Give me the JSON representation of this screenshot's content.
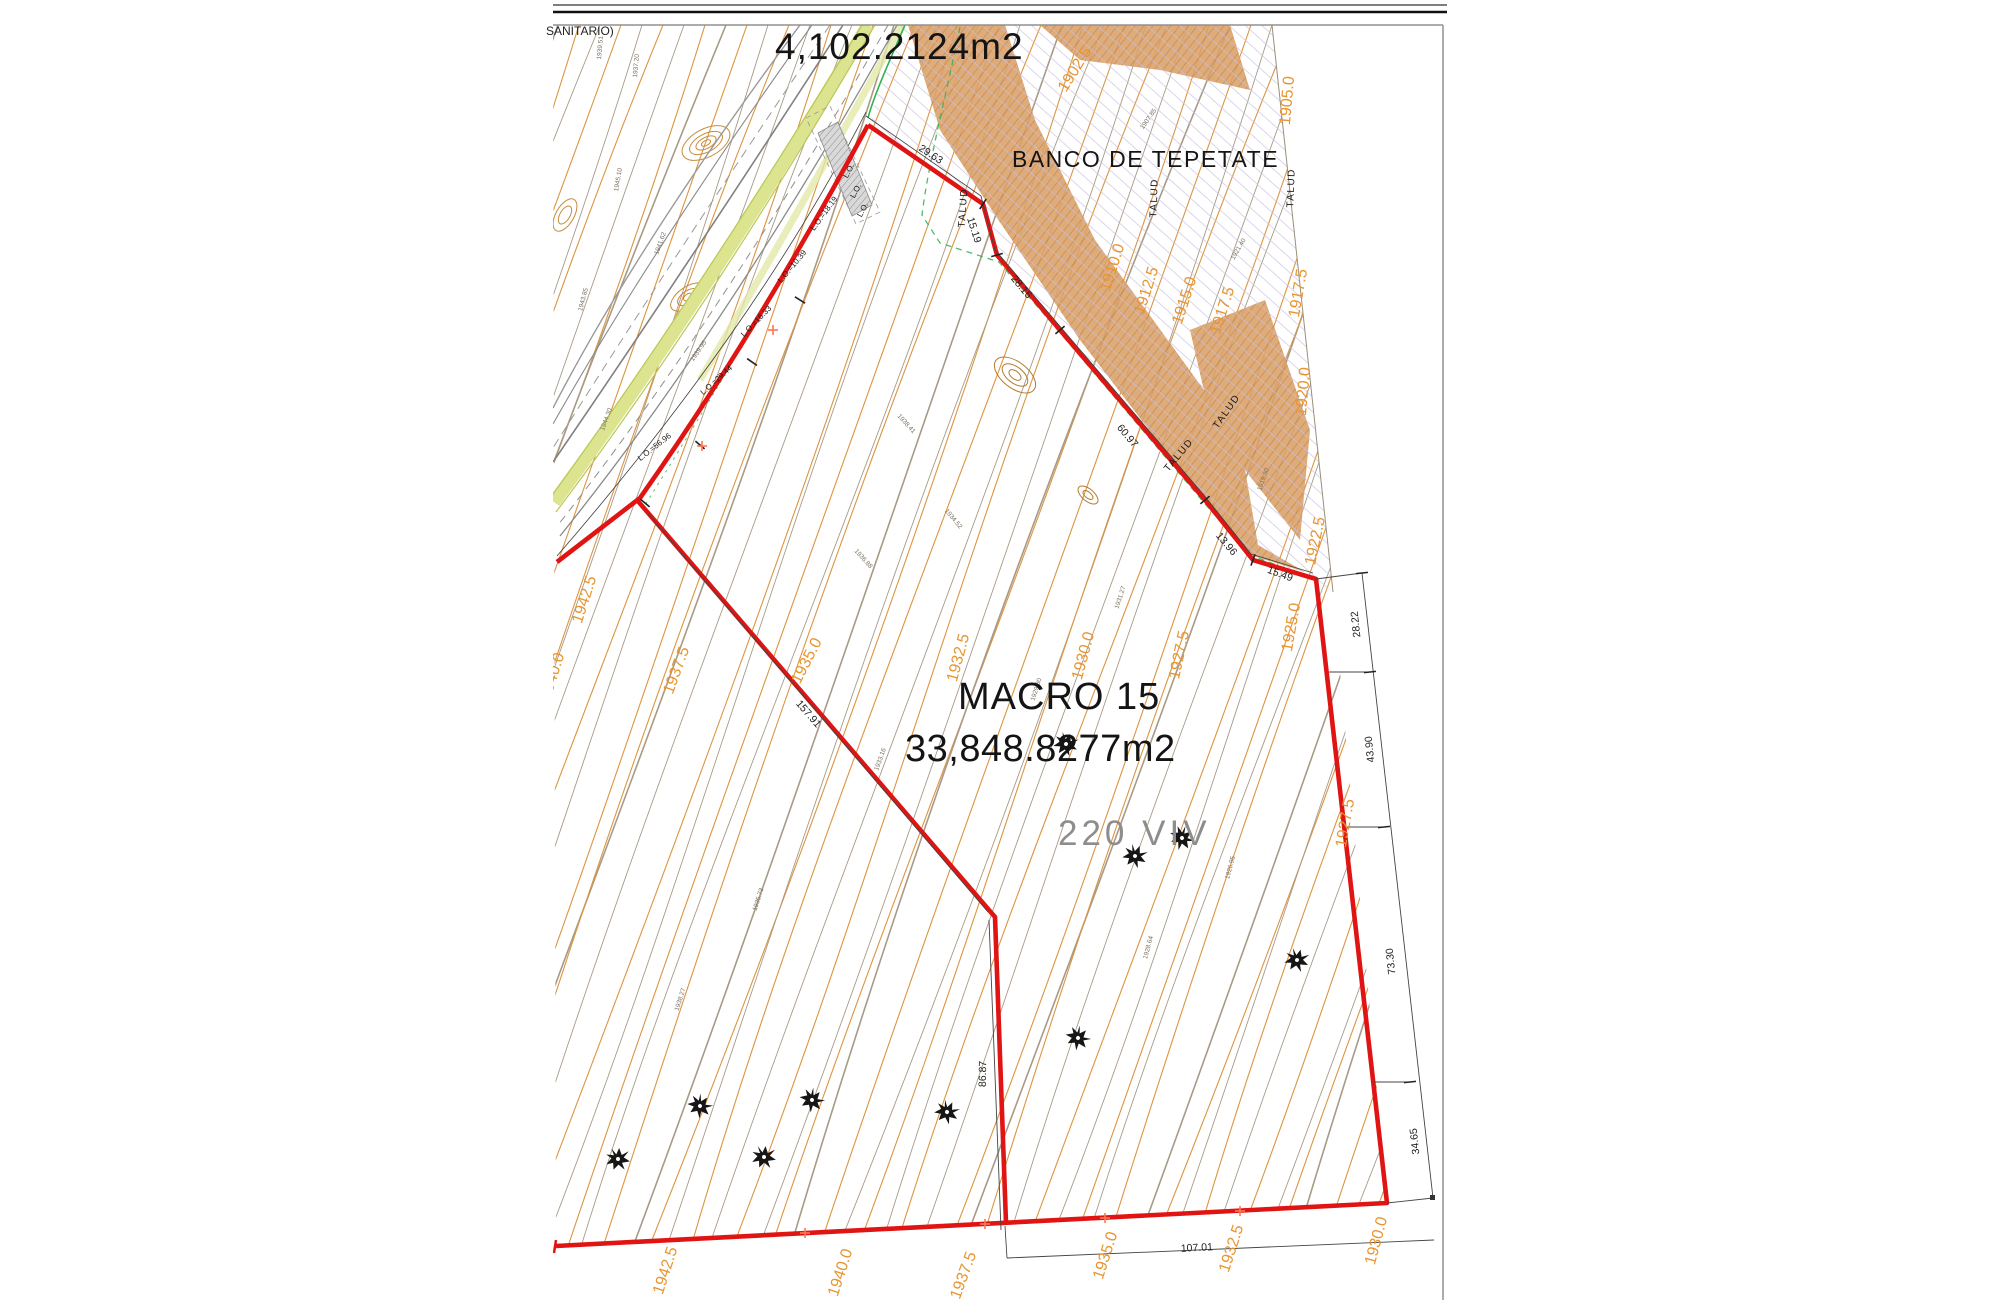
{
  "labels": {
    "area_top": "4,102.2124m2",
    "banco": "BANCO DE TEPETATE",
    "macro_title": "MACRO 15",
    "macro_area": "33,848.8277m2",
    "viviendas": "220 VIV",
    "sanitario": "SANITARIO)"
  },
  "colors": {
    "boundary_red": "#e11414",
    "contour_orange": "#dd9440",
    "contour_gray": "#a89a86",
    "label_orange": "#e8952f",
    "hatch_purple": "#c7c0e0",
    "talud_fill": "#daa068",
    "talud_stripe": "#bf7a38",
    "green_band": "#dce48f",
    "green_line": "#2fb14b",
    "dim_gray": "#444444"
  },
  "dimension_labels": [
    {
      "t": "29.63",
      "x": 929,
      "y": 157,
      "r": 33
    },
    {
      "t": "15.19",
      "x": 971,
      "y": 231,
      "r": 72
    },
    {
      "t": "28.16",
      "x": 1019,
      "y": 289,
      "r": 50
    },
    {
      "t": "60.97",
      "x": 1125,
      "y": 438,
      "r": 50
    },
    {
      "t": "13.96",
      "x": 1224,
      "y": 546,
      "r": 50
    },
    {
      "t": "15.49",
      "x": 1279,
      "y": 577,
      "r": 20
    },
    {
      "t": "28.22",
      "x": 1359,
      "y": 624,
      "r": -96
    },
    {
      "t": "43.90",
      "x": 1373,
      "y": 749,
      "r": -96
    },
    {
      "t": "73.30",
      "x": 1394,
      "y": 961,
      "r": -96
    },
    {
      "t": "34.65",
      "x": 1418,
      "y": 1141,
      "r": -96
    },
    {
      "t": "107.01",
      "x": 1197,
      "y": 1251,
      "r": -3
    },
    {
      "t": "86.87",
      "x": 986,
      "y": 1074,
      "r": -89
    },
    {
      "t": "157.91",
      "x": 806,
      "y": 716,
      "r": 49
    }
  ],
  "lo_labels": [
    {
      "t": "L.O.=56.96",
      "x": 656,
      "y": 449,
      "r": -38
    },
    {
      "t": "L.O.=29.44",
      "x": 718,
      "y": 382,
      "r": -42
    },
    {
      "t": "L.O.=16.33",
      "x": 758,
      "y": 323,
      "r": -46
    },
    {
      "t": "L.O.=10.39",
      "x": 794,
      "y": 268,
      "r": -50
    },
    {
      "t": "L.O.=18.19",
      "x": 826,
      "y": 215,
      "r": -54
    },
    {
      "t": "L.O.",
      "x": 851,
      "y": 172,
      "r": -62
    },
    {
      "t": "L.O.",
      "x": 858,
      "y": 192,
      "r": -62
    },
    {
      "t": "L.O.",
      "x": 865,
      "y": 211,
      "r": -62
    }
  ],
  "contour_labels": [
    {
      "t": "1942.5",
      "x": 670,
      "y": 1272,
      "r": -72
    },
    {
      "t": "1940.0",
      "x": 845,
      "y": 1274,
      "r": -72
    },
    {
      "t": "1937.5",
      "x": 968,
      "y": 1277,
      "r": -70
    },
    {
      "t": "1935.0",
      "x": 1110,
      "y": 1257,
      "r": -72
    },
    {
      "t": "1932.5",
      "x": 1236,
      "y": 1250,
      "r": -72
    },
    {
      "t": "1930.0",
      "x": 1381,
      "y": 1242,
      "r": -75
    },
    {
      "t": "1937.5",
      "x": 681,
      "y": 672,
      "r": -70
    },
    {
      "t": "1935.0",
      "x": 811,
      "y": 663,
      "r": -63
    },
    {
      "t": "1932.5",
      "x": 963,
      "y": 659,
      "r": -75
    },
    {
      "t": "1930.0",
      "x": 1088,
      "y": 657,
      "r": -75
    },
    {
      "t": "1927.5",
      "x": 1184,
      "y": 656,
      "r": -78
    },
    {
      "t": "1925.0",
      "x": 1296,
      "y": 628,
      "r": -80
    },
    {
      "t": "1927.5",
      "x": 1350,
      "y": 824,
      "r": -80
    },
    {
      "t": "1942.5",
      "x": 589,
      "y": 601,
      "r": -72
    },
    {
      "t": "1940.0",
      "x": 557,
      "y": 678,
      "r": -72
    },
    {
      "t": "1905.0",
      "x": 1292,
      "y": 101,
      "r": -85
    },
    {
      "t": "1902.5",
      "x": 1079,
      "y": 72,
      "r": -58
    },
    {
      "t": "1910.0",
      "x": 1117,
      "y": 269,
      "r": -72
    },
    {
      "t": "1912.5",
      "x": 1151,
      "y": 292,
      "r": -72
    },
    {
      "t": "1915.0",
      "x": 1189,
      "y": 302,
      "r": -72
    },
    {
      "t": "1917.5",
      "x": 1227,
      "y": 312,
      "r": -72
    },
    {
      "t": "1917.5",
      "x": 1303,
      "y": 294,
      "r": -80
    },
    {
      "t": "1920.0",
      "x": 1308,
      "y": 392,
      "r": -85
    },
    {
      "t": "1922.5",
      "x": 1320,
      "y": 542,
      "r": -78
    }
  ],
  "talud_labels": [
    {
      "t": "TALUD",
      "x": 966,
      "y": 208,
      "r": -86
    },
    {
      "t": "TALUD",
      "x": 1157,
      "y": 198,
      "r": -88
    },
    {
      "t": "TALUD",
      "x": 1294,
      "y": 188,
      "r": -88
    },
    {
      "t": "TALUD",
      "x": 1229,
      "y": 413,
      "r": -55
    },
    {
      "t": "TALUD",
      "x": 1181,
      "y": 457,
      "r": -50
    }
  ],
  "micro_labels": [
    {
      "t": "1939.51",
      "x": 602,
      "y": 48,
      "r": -85
    },
    {
      "t": "1937.20",
      "x": 638,
      "y": 66,
      "r": -85
    },
    {
      "t": "1945.10",
      "x": 620,
      "y": 180,
      "r": -80
    },
    {
      "t": "1941.62",
      "x": 662,
      "y": 244,
      "r": -70
    },
    {
      "t": "1943.85",
      "x": 585,
      "y": 300,
      "r": -75
    },
    {
      "t": "1944.30",
      "x": 608,
      "y": 420,
      "r": -70
    },
    {
      "t": "1939.95",
      "x": 700,
      "y": 352,
      "r": -55
    },
    {
      "t": "1938.41",
      "x": 905,
      "y": 425,
      "r": 48
    },
    {
      "t": "1936.88",
      "x": 862,
      "y": 560,
      "r": 48
    },
    {
      "t": "1934.52",
      "x": 952,
      "y": 520,
      "r": 50
    },
    {
      "t": "1931.27",
      "x": 1122,
      "y": 598,
      "r": -72
    },
    {
      "t": "1929.80",
      "x": 1038,
      "y": 690,
      "r": -72
    },
    {
      "t": "1933.16",
      "x": 882,
      "y": 760,
      "r": -70
    },
    {
      "t": "1928.64",
      "x": 1150,
      "y": 948,
      "r": -75
    },
    {
      "t": "1926.95",
      "x": 1232,
      "y": 868,
      "r": -75
    },
    {
      "t": "1935.73",
      "x": 760,
      "y": 900,
      "r": -72
    },
    {
      "t": "1938.27",
      "x": 682,
      "y": 1000,
      "r": -72
    },
    {
      "t": "1921.40",
      "x": 1240,
      "y": 250,
      "r": -60
    },
    {
      "t": "1907.85",
      "x": 1150,
      "y": 120,
      "r": -55
    },
    {
      "t": "1919.30",
      "x": 1265,
      "y": 480,
      "r": -70
    }
  ],
  "trees": [
    [
      700,
      1106
    ],
    [
      812,
      1100
    ],
    [
      947,
      1112
    ],
    [
      764,
      1157
    ],
    [
      618,
      1159
    ],
    [
      1078,
      1038
    ],
    [
      1135,
      856
    ],
    [
      1182,
      838
    ],
    [
      1066,
      744
    ],
    [
      1297,
      960
    ]
  ],
  "station_marks": [
    [
      805,
      1233
    ],
    [
      985,
      1224
    ],
    [
      1105,
      1218
    ],
    [
      1240,
      1211
    ],
    [
      702,
      446
    ],
    [
      773,
      330
    ]
  ]
}
